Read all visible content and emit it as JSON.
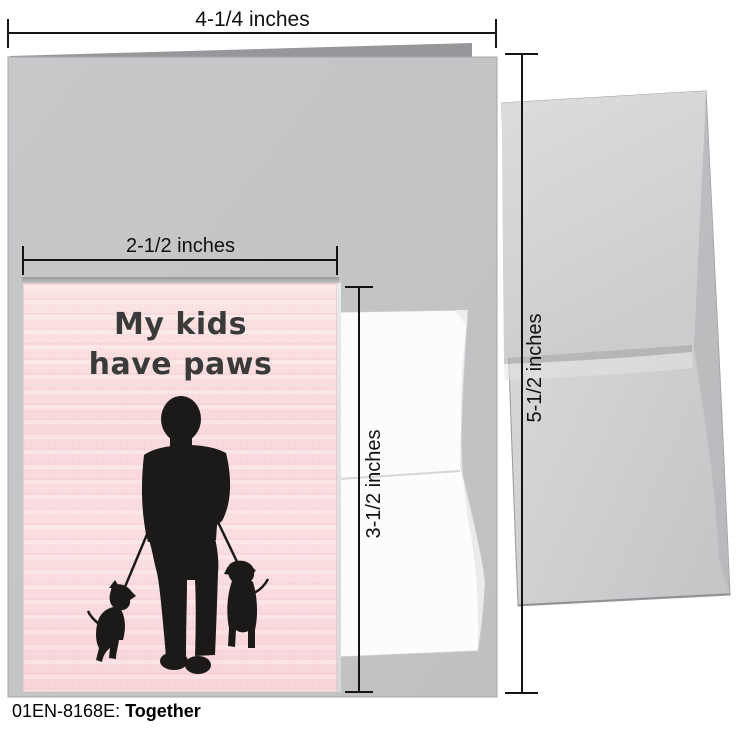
{
  "footer": {
    "code": "01EN-8168E:",
    "name": "Together"
  },
  "card": {
    "title_line1": "My kids",
    "title_line2": "have paws",
    "background_color": "#f8d7d9",
    "text_color": "#3a3a3a",
    "illustration": "black silhouette of a person seen from behind walking two black dogs on leashes"
  },
  "dimensions": {
    "open_card_width": "4-1/4 inches",
    "folded_card_width": "2-1/2 inches",
    "folded_card_height": "3-1/2 inches",
    "envelope_height": "5-1/2 inches"
  },
  "colors": {
    "large_card_gray": "#c5c6c8",
    "card_back_sliver_gray": "#96979a",
    "envelope_gray": "#d2d3d5",
    "small_envelope_white": "#fcfcfd",
    "measure_line_black": "#141414",
    "silhouette_black": "#1c1a19"
  }
}
